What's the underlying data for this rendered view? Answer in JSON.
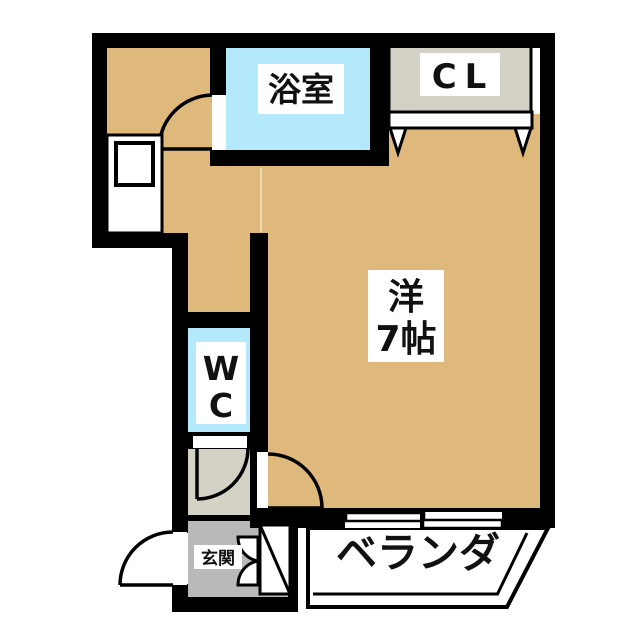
{
  "plan": {
    "title": "apartment-floor-plan",
    "rooms": {
      "bathroom": {
        "label": "浴室"
      },
      "closet": {
        "label": "CL"
      },
      "western_room": {
        "line1": "洋",
        "line2": "7帖"
      },
      "wc": {
        "line1": "W",
        "line2": "C"
      },
      "entrance": {
        "label": "玄関"
      },
      "veranda": {
        "label": "ベランダ"
      }
    },
    "colors": {
      "wall": "#000000",
      "floor": "#dfb97c",
      "wet_area": "#b4e9fb",
      "closet": "#d3d0c5",
      "hallway": "#d4d1c5",
      "entrance": "#b9b9b9",
      "label_bg": "#ffffff",
      "outside": "#ffffff"
    }
  }
}
